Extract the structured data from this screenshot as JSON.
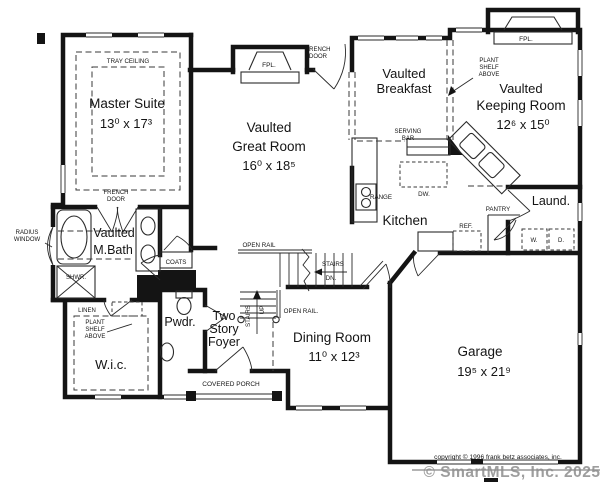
{
  "rooms": {
    "master_suite": {
      "name": "Master Suite",
      "dims": "13⁰ x 17³",
      "ceiling": "TRAY CEILING"
    },
    "master_bath": {
      "prefix": "Vaulted",
      "name": "M.Bath"
    },
    "great_room": {
      "prefix": "Vaulted",
      "name": "Great Room",
      "dims": "16⁰ x 18⁵"
    },
    "breakfast": {
      "prefix": "Vaulted",
      "name": "Breakfast"
    },
    "keeping_room": {
      "prefix": "Vaulted",
      "name": "Keeping Room",
      "dims": "12⁶ x 15⁰"
    },
    "kitchen": {
      "name": "Kitchen"
    },
    "dining_room": {
      "name": "Dining Room",
      "dims": "11⁰ x 12³"
    },
    "garage": {
      "name": "Garage",
      "dims": "19⁵ x 21⁹"
    },
    "wic": {
      "name": "W.i.c."
    },
    "powder": {
      "name": "Pwdr."
    },
    "foyer": {
      "line1": "Two",
      "line2": "Story",
      "line3": "Foyer"
    },
    "laundry": {
      "name": "Laund."
    },
    "porch": {
      "name": "COVERED PORCH"
    }
  },
  "annotations": {
    "french": "FRENCH",
    "door": "DOOR",
    "radius": "RADIUS",
    "window": "WINDOW",
    "plant": "PLANT",
    "shelf": "SHELF",
    "above": "ABOVE",
    "linen": "LINEN",
    "shower": "SHWR.",
    "coats": "COATS",
    "open_rail": "OPEN RAIL",
    "open_rail_dot": "OPEN RAIL.",
    "stairs": "STAIRS",
    "dn": "DN.",
    "up": "UP",
    "serving": "SERVING",
    "bar": "BAR",
    "range": "RANGE",
    "dw": "DW.",
    "ref": "REF.",
    "pantry": "PANTRY",
    "washer": "W.",
    "dryer": "D.",
    "fpl": "FPL."
  },
  "footer": {
    "copyright": "copyright © 1996 frank betz associates, inc.",
    "watermark": "© SmartMLS, Inc.  2025"
  },
  "colors": {
    "wall": "#141414",
    "watermark": "#8e8e8e",
    "background": "#ffffff"
  }
}
